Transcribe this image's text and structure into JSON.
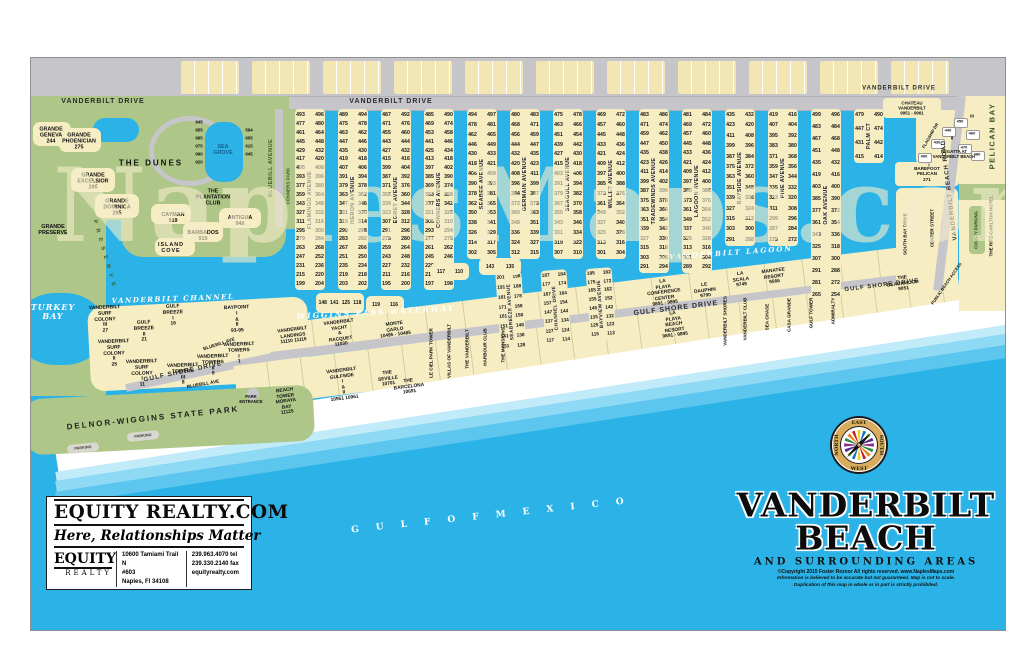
{
  "watermark": "NaplesMaps.com",
  "map_title": {
    "line1": "VANDERBILT",
    "line2": "BEACH",
    "subtitle": "AND SURROUNDING AREAS",
    "copyright1": "©Copyright 2015 Foster Reznor  All rights reserved.  www.NaplesMaps.com",
    "copyright2": "Information is believed to be accurate but not guaranteed. Map is not to scale.",
    "copyright3": "Duplication of this map in whole or in part is strictly prohibited."
  },
  "realty": {
    "brand": "EQUITY REALTY.COM",
    "tagline": "Here, Relationships Matter",
    "logo_top": "EQUITY",
    "logo_bottom": "REALTY",
    "address": [
      "10600 Tamiami Trail N",
      "#603",
      "Naples, Fl 34108"
    ],
    "contact": [
      "239.963.4070 tel",
      "239.330.2140 fax",
      "equityrealty.com"
    ]
  },
  "compass": {
    "top": "EAST",
    "right": "SOUTH",
    "bottom": "WEST",
    "left": "NORTH"
  },
  "roads": {
    "vanderbilt_drive": "VANDERBILT DRIVE",
    "gulf_shore_drive": "GULF SHORE DRIVE",
    "vanderbilt_beach_road": "VANDERBILT BEACH ROAD",
    "bluebill_avenue": "BLUEBILL AVENUE",
    "bluebill_ave": "BLUEBILL AVE",
    "south_bay_drive": "SOUTH BAY DRIVE",
    "center_street": "CENTER STREET",
    "flagship_drive": "FLAGSHIP DR",
    "public_access": "PUBLIC BEACH ACCESS"
  },
  "water": {
    "turkey_bay": "TURKEY BAY",
    "channel": "VANDERBILT CHANNEL",
    "wiggins": "WIGGINS PASS WATERWAY",
    "lagoon": "VANDERBILT LAGOON",
    "gulf": "G U L F   O F   M E X I C O",
    "pelican_bay": "PELICAN BAY"
  },
  "park": {
    "name": "DELNOR-WIGGINS STATE PARK",
    "entrance": "PARK ENTRANCE",
    "parking": "PARKING",
    "conners": "CONNERS PARK",
    "preserve": "P R E S E R V E"
  },
  "dunes": [
    {
      "n": "GRANDE GENEVA",
      "v": "244"
    },
    {
      "n": "GRANDE PHOENICIAN",
      "v": "275"
    },
    {
      "n": "GRANDE PRESERVE",
      "v": ""
    },
    {
      "n": "THE DUNES",
      "v": ""
    },
    {
      "n": "GRANDE EXCELSIOR",
      "v": "295"
    },
    {
      "n": "GRANDE DOMINICA",
      "v": "295"
    },
    {
      "n": "SEA GROVE",
      "v": ""
    },
    {
      "n": "THE PLANTATION CLUB",
      "v": ""
    },
    {
      "n": "CAYMAN",
      "v": "919"
    },
    {
      "n": "ANTIGUA",
      "v": "940"
    },
    {
      "n": "BARBADOS",
      "v": "919"
    },
    {
      "n": "ISLAND COVE",
      "v": ""
    }
  ],
  "sea_grove_nums": {
    "left": [
      "945",
      "955",
      "965",
      "975",
      "990",
      "920"
    ],
    "right": [
      "594",
      "605",
      "615",
      "645"
    ]
  },
  "island": [
    {
      "n": "VANDERBILT SURF COLONY III",
      "v": "27"
    },
    {
      "n": "GULF BREEZE I",
      "v": "16"
    },
    {
      "n": "GULF BREEZE II",
      "v": "21"
    },
    {
      "n": "BAYPOINT I & II",
      "v": "93-95"
    },
    {
      "n": "VANDERBILT SURF COLONY II",
      "v": "25"
    },
    {
      "n": "VANDERBILT SURF COLONY I",
      "v": "11"
    },
    {
      "n": "VANDERBILT TOWERS III",
      "v": "8"
    },
    {
      "n": "VANDERBILT TOWERS II",
      "v": "9"
    },
    {
      "n": "VANDERBILT TOWERS I",
      "v": "1"
    }
  ],
  "fingers": [
    {
      "name": "FLAMINGO AVENUE",
      "left": [
        493,
        477,
        461,
        445,
        429,
        417,
        405,
        393,
        377,
        359,
        343,
        327,
        311,
        295,
        279,
        263,
        247,
        231,
        215,
        199
      ],
      "right": [
        496,
        480,
        464,
        448,
        432,
        420,
        408,
        396,
        380,
        364,
        348,
        332,
        316,
        300,
        284,
        268,
        252,
        236,
        220,
        204
      ]
    },
    {
      "name": "HERON AVENUE",
      "left": [
        489,
        475,
        463,
        447,
        435,
        419,
        407,
        391,
        379,
        363,
        347,
        331,
        315,
        299,
        283,
        267,
        251,
        235,
        219,
        203
      ],
      "right": [
        494,
        478,
        462,
        446,
        430,
        418,
        406,
        394,
        378,
        362,
        346,
        330,
        314,
        298,
        282,
        266,
        250,
        234,
        218,
        202
      ]
    },
    {
      "name": "EGRET AVENUE",
      "left": [
        487,
        471,
        455,
        443,
        427,
        415,
        399,
        387,
        371,
        355,
        339,
        323,
        307,
        291,
        275,
        259,
        243,
        227,
        211,
        195
      ],
      "right": [
        492,
        476,
        460,
        444,
        432,
        416,
        404,
        392,
        376,
        360,
        344,
        328,
        312,
        296,
        280,
        264,
        248,
        232,
        216,
        200
      ]
    },
    {
      "name": "CONNERS AVENUE",
      "left": [
        485,
        469,
        453,
        441,
        425,
        413,
        397,
        385,
        369,
        353,
        337,
        321,
        305,
        293,
        277,
        261,
        245,
        229,
        213,
        197
      ],
      "right": [
        490,
        474,
        458,
        446,
        434,
        418,
        402,
        390,
        374,
        358,
        342,
        326,
        310,
        294,
        278,
        262,
        246,
        230,
        214,
        198
      ]
    },
    {
      "name": "SEABEE AVENUE",
      "left": [
        494,
        478,
        462,
        446,
        430,
        418,
        406,
        390,
        378,
        362,
        350,
        338,
        326,
        314,
        302
      ],
      "right": [
        497,
        481,
        465,
        449,
        433,
        421,
        409,
        393,
        381,
        365,
        353,
        341,
        329,
        317,
        305
      ]
    },
    {
      "name": "GERMAIN AVENUE",
      "left": [
        480,
        468,
        456,
        444,
        432,
        420,
        408,
        396,
        384,
        372,
        360,
        348,
        336,
        324,
        312
      ],
      "right": [
        483,
        471,
        459,
        447,
        435,
        423,
        411,
        399,
        387,
        375,
        363,
        351,
        339,
        327,
        315
      ]
    },
    {
      "name": "SEAGULL AVENUE",
      "left": [
        475,
        463,
        451,
        439,
        427,
        415,
        403,
        391,
        379,
        367,
        355,
        343,
        331,
        319,
        307
      ],
      "right": [
        478,
        466,
        454,
        442,
        430,
        418,
        406,
        394,
        382,
        370,
        358,
        346,
        334,
        322,
        310
      ]
    },
    {
      "name": "WILLET AVENUE",
      "left": [
        469,
        457,
        445,
        433,
        421,
        409,
        397,
        385,
        373,
        361,
        349,
        337,
        325,
        313,
        301
      ],
      "right": [
        472,
        460,
        448,
        436,
        424,
        412,
        400,
        388,
        376,
        364,
        352,
        340,
        328,
        316,
        304
      ]
    },
    {
      "name": "TRADEWINDS AVENUE",
      "left": [
        483,
        471,
        459,
        447,
        435,
        423,
        411,
        399,
        387,
        375,
        363,
        351,
        339,
        327,
        315,
        303,
        291
      ],
      "right": [
        486,
        474,
        462,
        450,
        438,
        426,
        414,
        402,
        390,
        378,
        366,
        354,
        342,
        330,
        318,
        306,
        294
      ]
    },
    {
      "name": "LAGOON AVENUE",
      "left": [
        481,
        469,
        457,
        445,
        433,
        421,
        409,
        397,
        385,
        373,
        361,
        349,
        337,
        325,
        313,
        301,
        289
      ],
      "right": [
        484,
        472,
        460,
        448,
        436,
        424,
        412,
        400,
        388,
        376,
        364,
        352,
        340,
        328,
        316,
        304,
        292
      ]
    },
    {
      "name": "BAYSIDE AVENUE",
      "left": [
        435,
        423,
        411,
        399,
        387,
        375,
        363,
        351,
        339,
        327,
        315,
        303,
        291
      ],
      "right": [
        432,
        420,
        408,
        396,
        384,
        372,
        360,
        348,
        336,
        324,
        312,
        300,
        288
      ]
    },
    {
      "name": "PINE AVENUE",
      "left": [
        419,
        407,
        395,
        383,
        371,
        359,
        347,
        335,
        323,
        311,
        299,
        287,
        275
      ],
      "right": [
        416,
        404,
        392,
        380,
        368,
        356,
        344,
        332,
        320,
        308,
        296,
        284,
        272
      ]
    },
    {
      "name": "OAK AVENUE",
      "left": [
        499,
        483,
        467,
        451,
        435,
        419,
        403,
        385,
        377,
        361,
        343,
        325,
        307,
        291,
        281,
        265
      ],
      "right": [
        496,
        484,
        468,
        448,
        432,
        416,
        400,
        390,
        372,
        354,
        336,
        318,
        300,
        288,
        272,
        254
      ]
    },
    {
      "name": "PALM CT",
      "left": [
        479,
        447,
        431,
        415
      ],
      "right": [
        490,
        474,
        442,
        414
      ]
    }
  ],
  "south_streets": [
    {
      "name": "SEABREEZE AVENUE",
      "left": [
        201,
        191,
        181,
        171,
        161,
        151,
        141,
        131
      ],
      "right": [
        198,
        188,
        178,
        168,
        158,
        148,
        138,
        128
      ]
    },
    {
      "name": "CHANNEL DRIVE",
      "left": [
        187,
        177,
        167,
        157,
        147,
        137,
        127,
        117
      ],
      "right": [
        184,
        174,
        164,
        154,
        144,
        134,
        124,
        114
      ]
    },
    {
      "name": "BAYVIEW AVENUE",
      "left": [
        185,
        175,
        165,
        155,
        145,
        135,
        125,
        115
      ],
      "right": [
        182,
        172,
        162,
        152,
        142,
        132,
        122,
        112
      ]
    }
  ],
  "islets": [
    [
      "148",
      "141",
      "125",
      "118"
    ],
    [
      "119",
      "116"
    ],
    [
      "117",
      "110"
    ],
    [
      "143",
      "135"
    ]
  ],
  "shore_north": [
    {
      "n": "VANDERBILT LANDINGS",
      "v": "11110  11116"
    },
    {
      "n": "VANDERBILT YACHT & RACQUET",
      "v": "11030"
    },
    {
      "n": "MONTE CARLO",
      "v": "10495 - 10485"
    },
    {
      "n": "LA PLAYA CONFERENCE CENTER",
      "v": "9891 - 9895"
    },
    {
      "n": "LE DAUPHIN",
      "v": "9790"
    },
    {
      "n": "LA SCALA",
      "v": "9749"
    },
    {
      "n": "MANATEE RESORT",
      "v": "9566"
    }
  ],
  "shore_south": [
    {
      "n": "BEACH TOWER MORAYA BAY",
      "v": "11125"
    },
    {
      "n": "VANDERBILT GULFSIDE I & II",
      "v": "10951  10961"
    },
    {
      "n": "THE SEVILLE",
      "v": "10701"
    },
    {
      "n": "THE BARCELONA",
      "v": "10691"
    },
    {
      "n": "LA PLAYA BEACH RESORT",
      "v": "9891 - 9895"
    },
    {
      "n": "THE BEACHMOOR",
      "v": "9051"
    }
  ],
  "shore_verticals": [
    "LE CIEL PARK TOWER",
    "VILLAS OF VANDERBILT",
    "THE VANDERBILT",
    "HARBOUR CLUB",
    "THE MANSIONS",
    "VANDERBILT SHORES",
    "VANDERBILT CLUB",
    "SEA CHASE",
    "CASA GRANDE",
    "GULF TOWER",
    "ADMIRALTY"
  ],
  "right": {
    "chateau": {
      "n": "CHATEAU VANDERBILT",
      "v": "9951 - 9961"
    },
    "regatta": {
      "n": "REGATTA AT VANDERBILT BEACH",
      "buildings": [
        "400",
        "430",
        "440",
        "450",
        "460",
        "470",
        "480"
      ],
      "phases": [
        "I",
        "II",
        "III"
      ]
    },
    "barefoot": {
      "n": "BAREFOOT PELICAN",
      "v": "271"
    },
    "ritz": "THE RITZ-CARLTON HOTEL",
    "county_parking": "COUNTY PARKING"
  }
}
